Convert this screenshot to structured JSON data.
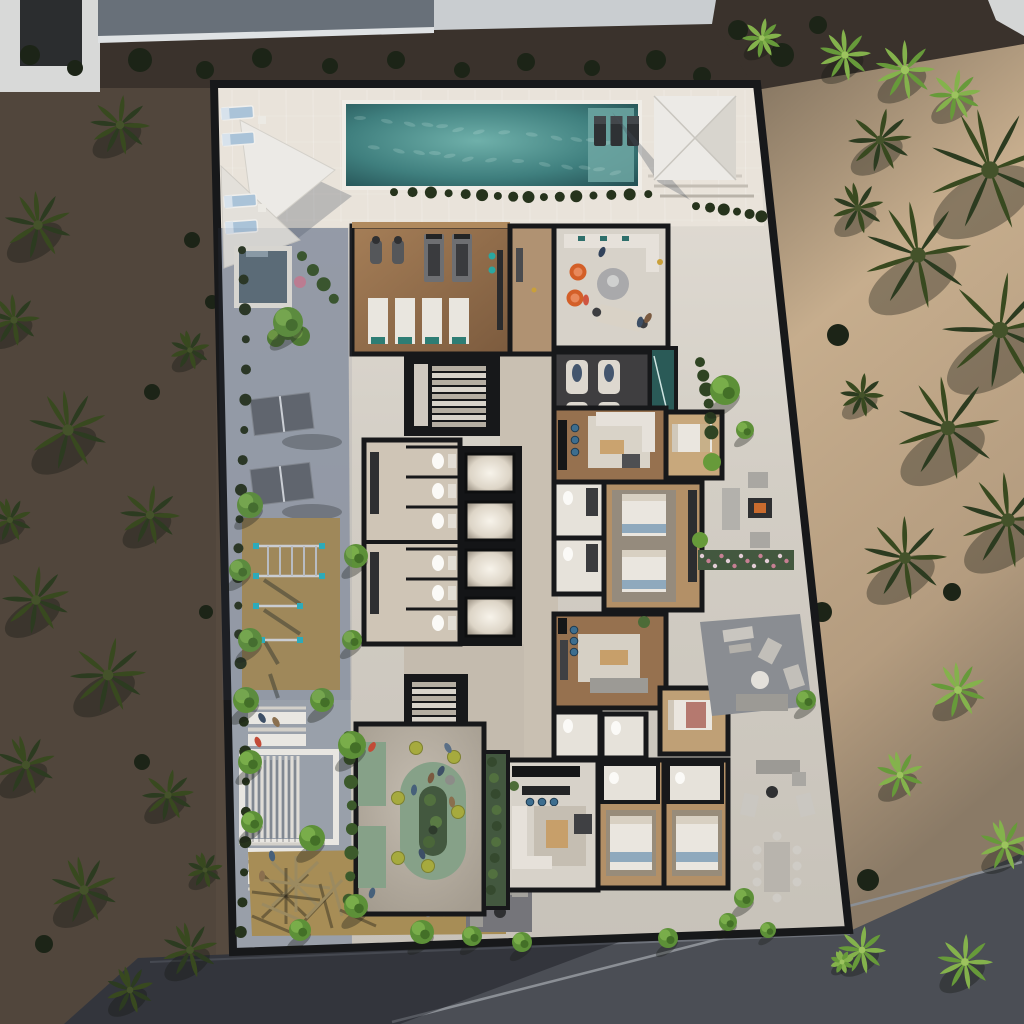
{
  "scene": {
    "type": "aerial-3d-architectural-render",
    "view": "top-down",
    "lighting": "dusk-low-sun",
    "setting": "beachfront residential amenity podium surrounded by palm grove and sand",
    "visible_text": "none"
  },
  "palette": {
    "soil_dark": "#3a322c",
    "ground_left": "#564a3f",
    "sand_lit": "#c3aa8a",
    "sand_shadow": "#837260",
    "road": "#4b4e55",
    "road_curb": "#8b8f95",
    "roof_gray": "#687079",
    "building_white": "#d8d9d8",
    "deck": "#dcd7ce",
    "deck_lit": "#e9e3da",
    "concrete_shadow": "#939ba7",
    "wall_cut": "#17181a",
    "pool_water": "#40807f",
    "pool_shelf": "#6fa7a3",
    "plunge_pool": "#5c6d77",
    "indoor_plunge": "#2a5a57",
    "wood_floor": "#96714f",
    "wood_light": "#b09272",
    "floor_light": "#d7d2c9",
    "floor_warm": "#c9c0b2",
    "dark_room": "#3f3e40",
    "sofa_white": "#e6e1da",
    "sofa_gray": "#9c9a95",
    "accent_orange": "#d35f28",
    "teal_accent": "#2e6f6b",
    "bed_blue": "#8fa9bd",
    "bed_white": "#eae6df",
    "rose_bed": "#b5796f",
    "courtyard_floor": "#b6afa3",
    "sage_bench": "#86a188",
    "planting_dark": "#43583f",
    "lime_pouf": "#a6aa3e",
    "tan_ground": "#a78d56",
    "palm_dark": "#243020",
    "palm_lit": "#679a3a",
    "tree_green": "#5d9038",
    "hedge_dark": "#26331c",
    "flower_pink": "#c77f93",
    "stool_blue": "#3d6e8f",
    "fire_glow": "#c96b2e",
    "sail_white": "#eceae6",
    "lounger_blue": "#aac3d8"
  },
  "counts": {
    "shade_sails": 2,
    "sun_loungers": 4,
    "in_pool_loungers": 3,
    "treadmills": 2,
    "exercise_bikes": 2,
    "gym_mats": 4,
    "relax_recliners": 4,
    "wc_stalls": 6,
    "elevators": 4,
    "stairwells": 2,
    "orange_lounge_chairs": 2,
    "courtyard_poufs": 6,
    "table_tennis_tables": 2,
    "picnic_tables": 4,
    "outdoor_dining_chairs": 8,
    "apartment_beds": 6,
    "kitchen_stool_sets": 3,
    "terrace_lounge_sets": 3
  },
  "amenities": [
    "lap-pool",
    "pool-shade-sails",
    "cantilever-umbrella",
    "plunge-pool",
    "sun-deck",
    "gym",
    "lobby-lounge",
    "co-work-desk",
    "relaxation-room",
    "indoor-plunge",
    "changing-rooms",
    "elevator-bank",
    "stair-cores",
    "residential-apartments",
    "courtyard-playground",
    "oval-planter-bench",
    "table-tennis",
    "calisthenics-rig",
    "pergola",
    "picnic-tables",
    "kids-play-structure",
    "outdoor-lounges",
    "fire-pit",
    "outdoor-dining",
    "palm-garden"
  ]
}
